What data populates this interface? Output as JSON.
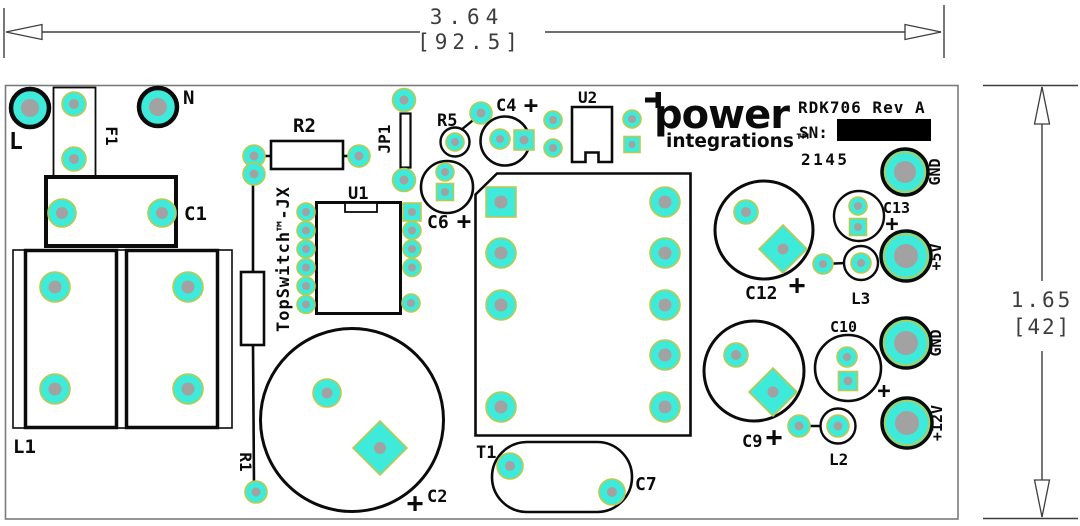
{
  "colors": {
    "pad_teal": "#3EEBDA",
    "pad_center_gray": "#A2A2A2",
    "pad_ring_olive": "#BCC94F",
    "silkscreen_black": "#0b0b0b",
    "board_edge_gray": "#7b7b7b",
    "dimension_gray": "#3d3d3d",
    "sn_box_black": "#000000"
  },
  "dimensions": {
    "width_inches": "3.64",
    "width_mm": "[92.5]",
    "height_inches": "1.65",
    "height_mm": "[42]"
  },
  "branding": {
    "logo_line1": "power",
    "logo_line2": "integrations™",
    "product": "RDK706 Rev A",
    "sn_label": "SN:",
    "lot_code": "2145"
  },
  "labels": {
    "l_terminal": "L",
    "n_terminal": "N",
    "f1": "F1",
    "c1": "C1",
    "l1": "L1",
    "r1": "R1",
    "r2": "R2",
    "jp1": "JP1",
    "u1": "U1",
    "topswitch": "TopSwitch™-JX",
    "r5": "R5",
    "c4": "C4",
    "c6": "C6",
    "c2": "C2",
    "u2": "U2",
    "t1": "T1",
    "c7": "C7",
    "c12": "C12",
    "c13": "C13",
    "l3": "L3",
    "c9": "C9",
    "c10": "C10",
    "l2": "L2",
    "gnd_top": "GND",
    "plus5v": "+5V",
    "gnd_bottom": "GND",
    "plus12v": "+12V",
    "plus": "+"
  }
}
